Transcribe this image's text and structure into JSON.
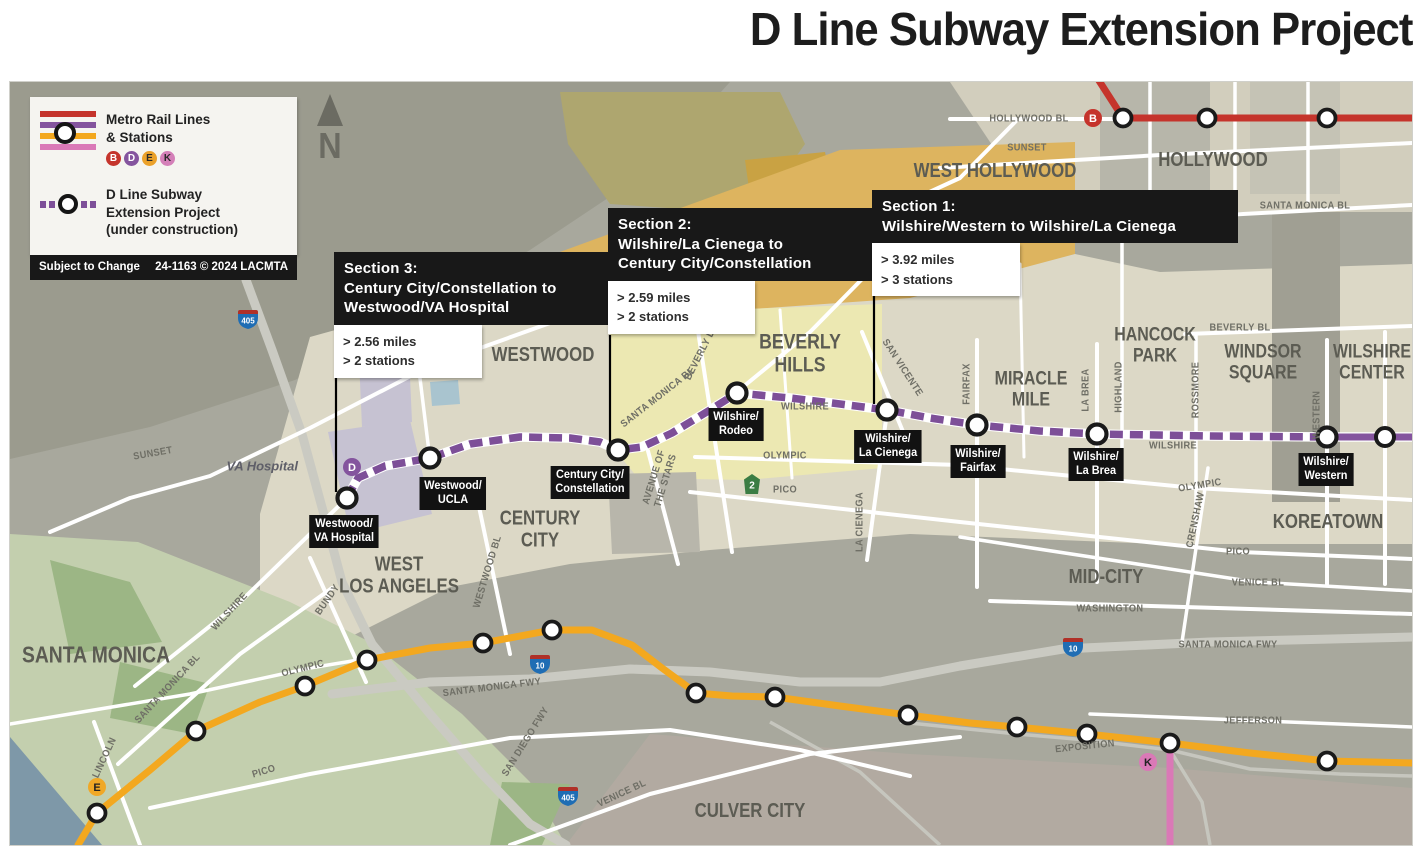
{
  "title": "D Line Subway Extension Project",
  "north_label": "N",
  "colors": {
    "b_line": "#c5342c",
    "d_line": "#84549e",
    "d_dash": "#7d4f98",
    "e_line": "#f3a81f",
    "k_line": "#da79b7",
    "road": "#ffffff",
    "freeway": "#cacac2",
    "map_base": "#a8a89d",
    "callout_bg": "#181818",
    "station_fill": "#ffffff",
    "station_ring": "#1a1a1a"
  },
  "legend": {
    "rail_label": "Metro Rail Lines\n& Stations",
    "extension_label": "D Line Subway\nExtension Project\n(under construction)",
    "badges": [
      {
        "l": "B",
        "bg": "#c5342c",
        "fg": "#ffffff"
      },
      {
        "l": "D",
        "bg": "#84549e",
        "fg": "#ffffff"
      },
      {
        "l": "E",
        "bg": "#eba12a",
        "fg": "#2a2a2a"
      },
      {
        "l": "K",
        "bg": "#d47fb8",
        "fg": "#2a2a2a"
      }
    ],
    "footer_left": "Subject to Change",
    "footer_right": "24-1163 © 2024 LACMTA"
  },
  "callouts": [
    {
      "heading": "Section 3:",
      "route": "Century City/Constellation to\nWestwood/VA Hospital",
      "stats": "> 2.56 miles\n> 2 stations",
      "connector": [
        326,
        296,
        326,
        410
      ]
    },
    {
      "heading": "Section 2:",
      "route": "Wilshire/La Cienega to\nCentury City/Constellation",
      "stats": "> 2.59 miles\n> 2 stations",
      "connector": [
        600,
        253,
        600,
        362
      ]
    },
    {
      "heading": "Section 1:",
      "route": "Wilshire/Western to Wilshire/La Cienega",
      "stats": "> 3.92 miles\n> 3 stations",
      "connector": [
        864,
        213,
        864,
        322
      ]
    }
  ],
  "rail": {
    "b": {
      "path": "M1086,-6 L1113,36 L1402,36",
      "stations": [
        [
          1113,
          36
        ],
        [
          1197,
          36
        ],
        [
          1317,
          36
        ]
      ]
    },
    "e": {
      "path": "M68,763 L87,731 L140,688 L186,649 L250,620 L295,604 L357,578 L420,566 L473,561 L542,548 L582,548 L622,563 L652,586 L686,611 L722,614 L765,615 L830,624 L898,633 L960,641 L1007,645 L1077,652 L1160,661 L1240,671 L1317,679 L1402,681",
      "stations": [
        [
          87,
          731
        ],
        [
          186,
          649
        ],
        [
          295,
          604
        ],
        [
          357,
          578
        ],
        [
          473,
          561
        ],
        [
          542,
          548
        ],
        [
          686,
          611
        ],
        [
          765,
          615
        ],
        [
          898,
          633
        ],
        [
          1007,
          645
        ],
        [
          1077,
          652
        ],
        [
          1160,
          661
        ],
        [
          1317,
          679
        ]
      ]
    },
    "k": {
      "path": "M1160,661 L1160,763",
      "stations": []
    },
    "d_solid": {
      "path": "M1317,355 L1402,355",
      "stations": [
        [
          1375,
          355
        ]
      ]
    },
    "d_extension": {
      "path": "M337,416 L348,396 L375,384 L420,376 L460,362 L510,355 L560,356 L590,360 L608,368 L632,365 L662,351 L700,328 L727,311 L780,316 L830,322 L877,328 L920,336 L967,343 L1030,349 L1087,352 L1200,354 L1317,355"
    }
  },
  "d_stations": [
    {
      "name": "Westwood/\nVA Hospital",
      "cx": 337,
      "cy": 416,
      "lx": 334,
      "ly": 433
    },
    {
      "name": "Westwood/\nUCLA",
      "cx": 420,
      "cy": 376,
      "lx": 443,
      "ly": 395
    },
    {
      "name": "Century City/\nConstellation",
      "cx": 608,
      "cy": 368,
      "lx": 580,
      "ly": 384
    },
    {
      "name": "Wilshire/\nRodeo",
      "cx": 727,
      "cy": 311,
      "lx": 726,
      "ly": 326
    },
    {
      "name": "Wilshire/\nLa Cienega",
      "cx": 877,
      "cy": 328,
      "lx": 878,
      "ly": 348
    },
    {
      "name": "Wilshire/\nFairfax",
      "cx": 967,
      "cy": 343,
      "lx": 968,
      "ly": 363
    },
    {
      "name": "Wilshire/\nLa Brea",
      "cx": 1087,
      "cy": 352,
      "lx": 1086,
      "ly": 366
    },
    {
      "name": "Wilshire/\nWestern",
      "cx": 1317,
      "cy": 355,
      "lx": 1316,
      "ly": 371
    }
  ],
  "badges": [
    {
      "l": "B",
      "x": 1083,
      "y": 36,
      "bg": "#c5342c",
      "fg": "#ffffff"
    },
    {
      "l": "D",
      "x": 342,
      "y": 385,
      "bg": "#84549e",
      "fg": "#ffffff"
    },
    {
      "l": "E",
      "x": 87,
      "y": 705,
      "bg": "#f0a826",
      "fg": "#222222"
    },
    {
      "l": "K",
      "x": 1138,
      "y": 680,
      "bg": "#da79b7",
      "fg": "#222222"
    }
  ],
  "shields": [
    {
      "kind": "interstate",
      "label": "405",
      "x": 238,
      "y": 238
    },
    {
      "kind": "interstate",
      "label": "405",
      "x": 558,
      "y": 715
    },
    {
      "kind": "interstate",
      "label": "10",
      "x": 530,
      "y": 583
    },
    {
      "kind": "interstate",
      "label": "10",
      "x": 1063,
      "y": 566
    },
    {
      "kind": "state",
      "label": "2",
      "x": 742,
      "y": 402
    }
  ],
  "neighborhoods": [
    {
      "t": "SANTA MONICA",
      "x": 86,
      "y": 573,
      "s": 23
    },
    {
      "t": "WEST\nLOS ANGELES",
      "x": 389,
      "y": 494,
      "s": 20
    },
    {
      "t": "WESTWOOD",
      "x": 533,
      "y": 274,
      "s": 20
    },
    {
      "t": "CENTURY\nCITY",
      "x": 530,
      "y": 448,
      "s": 20
    },
    {
      "t": "BEVERLY\nHILLS",
      "x": 790,
      "y": 272,
      "s": 21
    },
    {
      "t": "WEST HOLLYWOOD",
      "x": 985,
      "y": 90,
      "s": 20
    },
    {
      "t": "HOLLYWOOD",
      "x": 1203,
      "y": 79,
      "s": 20
    },
    {
      "t": "HANCOCK\nPARK",
      "x": 1145,
      "y": 264,
      "s": 19
    },
    {
      "t": "WINDSOR\nSQUARE",
      "x": 1253,
      "y": 281,
      "s": 19
    },
    {
      "t": "WILSHIRE\nCENTER",
      "x": 1362,
      "y": 281,
      "s": 19
    },
    {
      "t": "MIRACLE\nMILE",
      "x": 1021,
      "y": 308,
      "s": 19
    },
    {
      "t": "MID-CITY",
      "x": 1096,
      "y": 496,
      "s": 20
    },
    {
      "t": "KOREATOWN",
      "x": 1318,
      "y": 441,
      "s": 20
    },
    {
      "t": "CULVER CITY",
      "x": 740,
      "y": 730,
      "s": 20
    }
  ],
  "streets": [
    {
      "t": "HOLLYWOOD BL",
      "x": 1019,
      "y": 37,
      "r": 0
    },
    {
      "t": "SUNSET",
      "x": 1017,
      "y": 66,
      "r": 0
    },
    {
      "t": "SANTA MONICA BL",
      "x": 1295,
      "y": 124,
      "r": 0
    },
    {
      "t": "BEVERLY BL",
      "x": 1230,
      "y": 246,
      "r": 0
    },
    {
      "t": "SAN VICENTE",
      "x": 892,
      "y": 286,
      "r": 57
    },
    {
      "t": "FAIRFAX",
      "x": 957,
      "y": 302,
      "r": -90
    },
    {
      "t": "LA BREA",
      "x": 1076,
      "y": 308,
      "r": -90
    },
    {
      "t": "HIGHLAND",
      "x": 1109,
      "y": 305,
      "r": -90
    },
    {
      "t": "ROSSMORE",
      "x": 1186,
      "y": 308,
      "r": -90
    },
    {
      "t": "WESTERN",
      "x": 1307,
      "y": 333,
      "r": -90
    },
    {
      "t": "LA CIENEGA",
      "x": 850,
      "y": 440,
      "r": -90
    },
    {
      "t": "CRENSHAW",
      "x": 1186,
      "y": 438,
      "r": -78
    },
    {
      "t": "WILSHIRE",
      "x": 795,
      "y": 325,
      "r": 0
    },
    {
      "t": "WILSHIRE",
      "x": 1163,
      "y": 364,
      "r": 0
    },
    {
      "t": "OLYMPIC",
      "x": 775,
      "y": 374,
      "r": 0
    },
    {
      "t": "OLYMPIC",
      "x": 1190,
      "y": 404,
      "r": -9
    },
    {
      "t": "PICO",
      "x": 775,
      "y": 408,
      "r": 0
    },
    {
      "t": "PICO",
      "x": 1228,
      "y": 470,
      "r": 0
    },
    {
      "t": "VENICE BL",
      "x": 1248,
      "y": 501,
      "r": 0
    },
    {
      "t": "WASHINGTON",
      "x": 1100,
      "y": 527,
      "r": 0
    },
    {
      "t": "SANTA MONICA FWY",
      "x": 1218,
      "y": 563,
      "r": 0
    },
    {
      "t": "JEFFERSON",
      "x": 1243,
      "y": 639,
      "r": 0
    },
    {
      "t": "EXPOSITION",
      "x": 1075,
      "y": 665,
      "r": -6
    },
    {
      "t": "SUNSET",
      "x": 143,
      "y": 372,
      "r": -10
    },
    {
      "t": "WILSHIRE",
      "x": 220,
      "y": 530,
      "r": -47
    },
    {
      "t": "SANTA MONICA BL",
      "x": 158,
      "y": 607,
      "r": -47
    },
    {
      "t": "LINCOLN",
      "x": 95,
      "y": 676,
      "r": -65
    },
    {
      "t": "OLYMPIC",
      "x": 293,
      "y": 587,
      "r": -14
    },
    {
      "t": "PICO",
      "x": 254,
      "y": 690,
      "r": -17
    },
    {
      "t": "BUNDY",
      "x": 318,
      "y": 518,
      "r": -55
    },
    {
      "t": "WESTWOOD BL",
      "x": 478,
      "y": 490,
      "r": -73
    },
    {
      "t": "SAN DIEGO FWY",
      "x": 516,
      "y": 660,
      "r": -58
    },
    {
      "t": "SANTA MONICA FWY",
      "x": 482,
      "y": 606,
      "r": -7
    },
    {
      "t": "VENICE BL",
      "x": 612,
      "y": 712,
      "r": -25
    },
    {
      "t": "SANTA MONICA BL",
      "x": 648,
      "y": 316,
      "r": -38
    },
    {
      "t": "BEVERLY DR",
      "x": 692,
      "y": 270,
      "r": -63
    },
    {
      "t": "AVENUE OF\nTHE STARS",
      "x": 650,
      "y": 397,
      "r": -73
    }
  ],
  "misc_labels": [
    {
      "t": "VA Hospital",
      "x": 288,
      "y": 384
    }
  ]
}
